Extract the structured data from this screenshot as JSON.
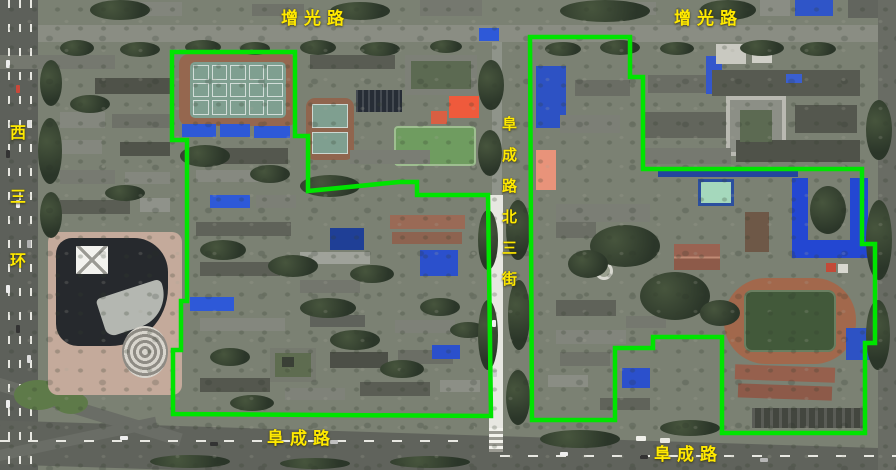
{
  "map": {
    "type": "satellite-map",
    "road_labels": {
      "zengguang_left": "增光路",
      "zengguang_right": "增光路",
      "xisanhuan": "西三环",
      "fucheng_north_3rd_street": "阜成路北三街",
      "fucheng_left": "阜成路",
      "fucheng_right": "阜成路"
    },
    "label_color": "#ffe900",
    "overlay": {
      "boundary_color": "#00e400",
      "boundary_width": 4.5,
      "campus_boundaries": [
        {
          "name": "west-campus",
          "points": [
            [
              172,
              52
            ],
            [
              295,
              52
            ],
            [
              295,
              136
            ],
            [
              308,
              136
            ],
            [
              308,
              191
            ],
            [
              399,
              182
            ],
            [
              417,
              182
            ],
            [
              417,
              195
            ],
            [
              488,
              195
            ],
            [
              491,
              416
            ],
            [
              173,
              414
            ],
            [
              173,
              350
            ],
            [
              181,
              350
            ],
            [
              181,
              301
            ],
            [
              187,
              301
            ],
            [
              187,
              140
            ],
            [
              172,
              140
            ]
          ]
        },
        {
          "name": "east-campus",
          "points": [
            [
              530,
              37
            ],
            [
              630,
              37
            ],
            [
              630,
              77
            ],
            [
              643,
              77
            ],
            [
              643,
              169
            ],
            [
              862,
              169
            ],
            [
              862,
              244
            ],
            [
              875,
              244
            ],
            [
              875,
              343
            ],
            [
              865,
              343
            ],
            [
              865,
              433
            ],
            [
              722,
              433
            ],
            [
              722,
              337
            ],
            [
              653,
              337
            ],
            [
              653,
              348
            ],
            [
              615,
              348
            ],
            [
              615,
              420
            ],
            [
              532,
              420
            ]
          ]
        }
      ]
    }
  }
}
